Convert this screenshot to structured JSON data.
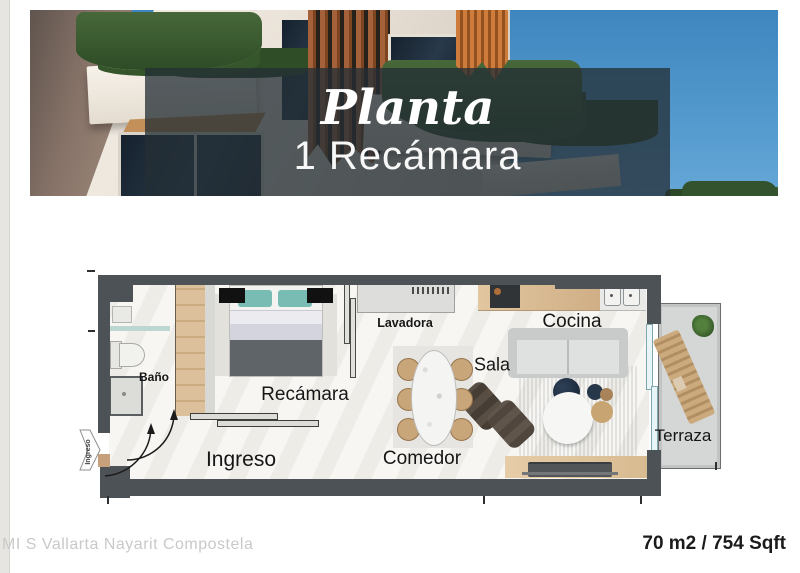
{
  "hero": {
    "script_title": "Planta",
    "subtitle": "1 Recámara"
  },
  "floorplan": {
    "labels": {
      "bano": "Baño",
      "recamara": "Recámara",
      "lavadora": "Lavadora",
      "cocina": "Cocina",
      "sala": "Sala",
      "comedor": "Comedor",
      "ingreso": "Ingreso",
      "terraza": "Terraza"
    },
    "entry_arrow_label": "Ingreso"
  },
  "footer": {
    "watermark": "MI S Vallarta Nayarit Compostela",
    "area": "70 m2 / 754 Sqft"
  },
  "colors": {
    "wall": "#4d5257",
    "wood": "#d5b88f",
    "sky": "#4a90c8",
    "overlay": "#242e34",
    "pillow_teal": "#79bcb4"
  }
}
